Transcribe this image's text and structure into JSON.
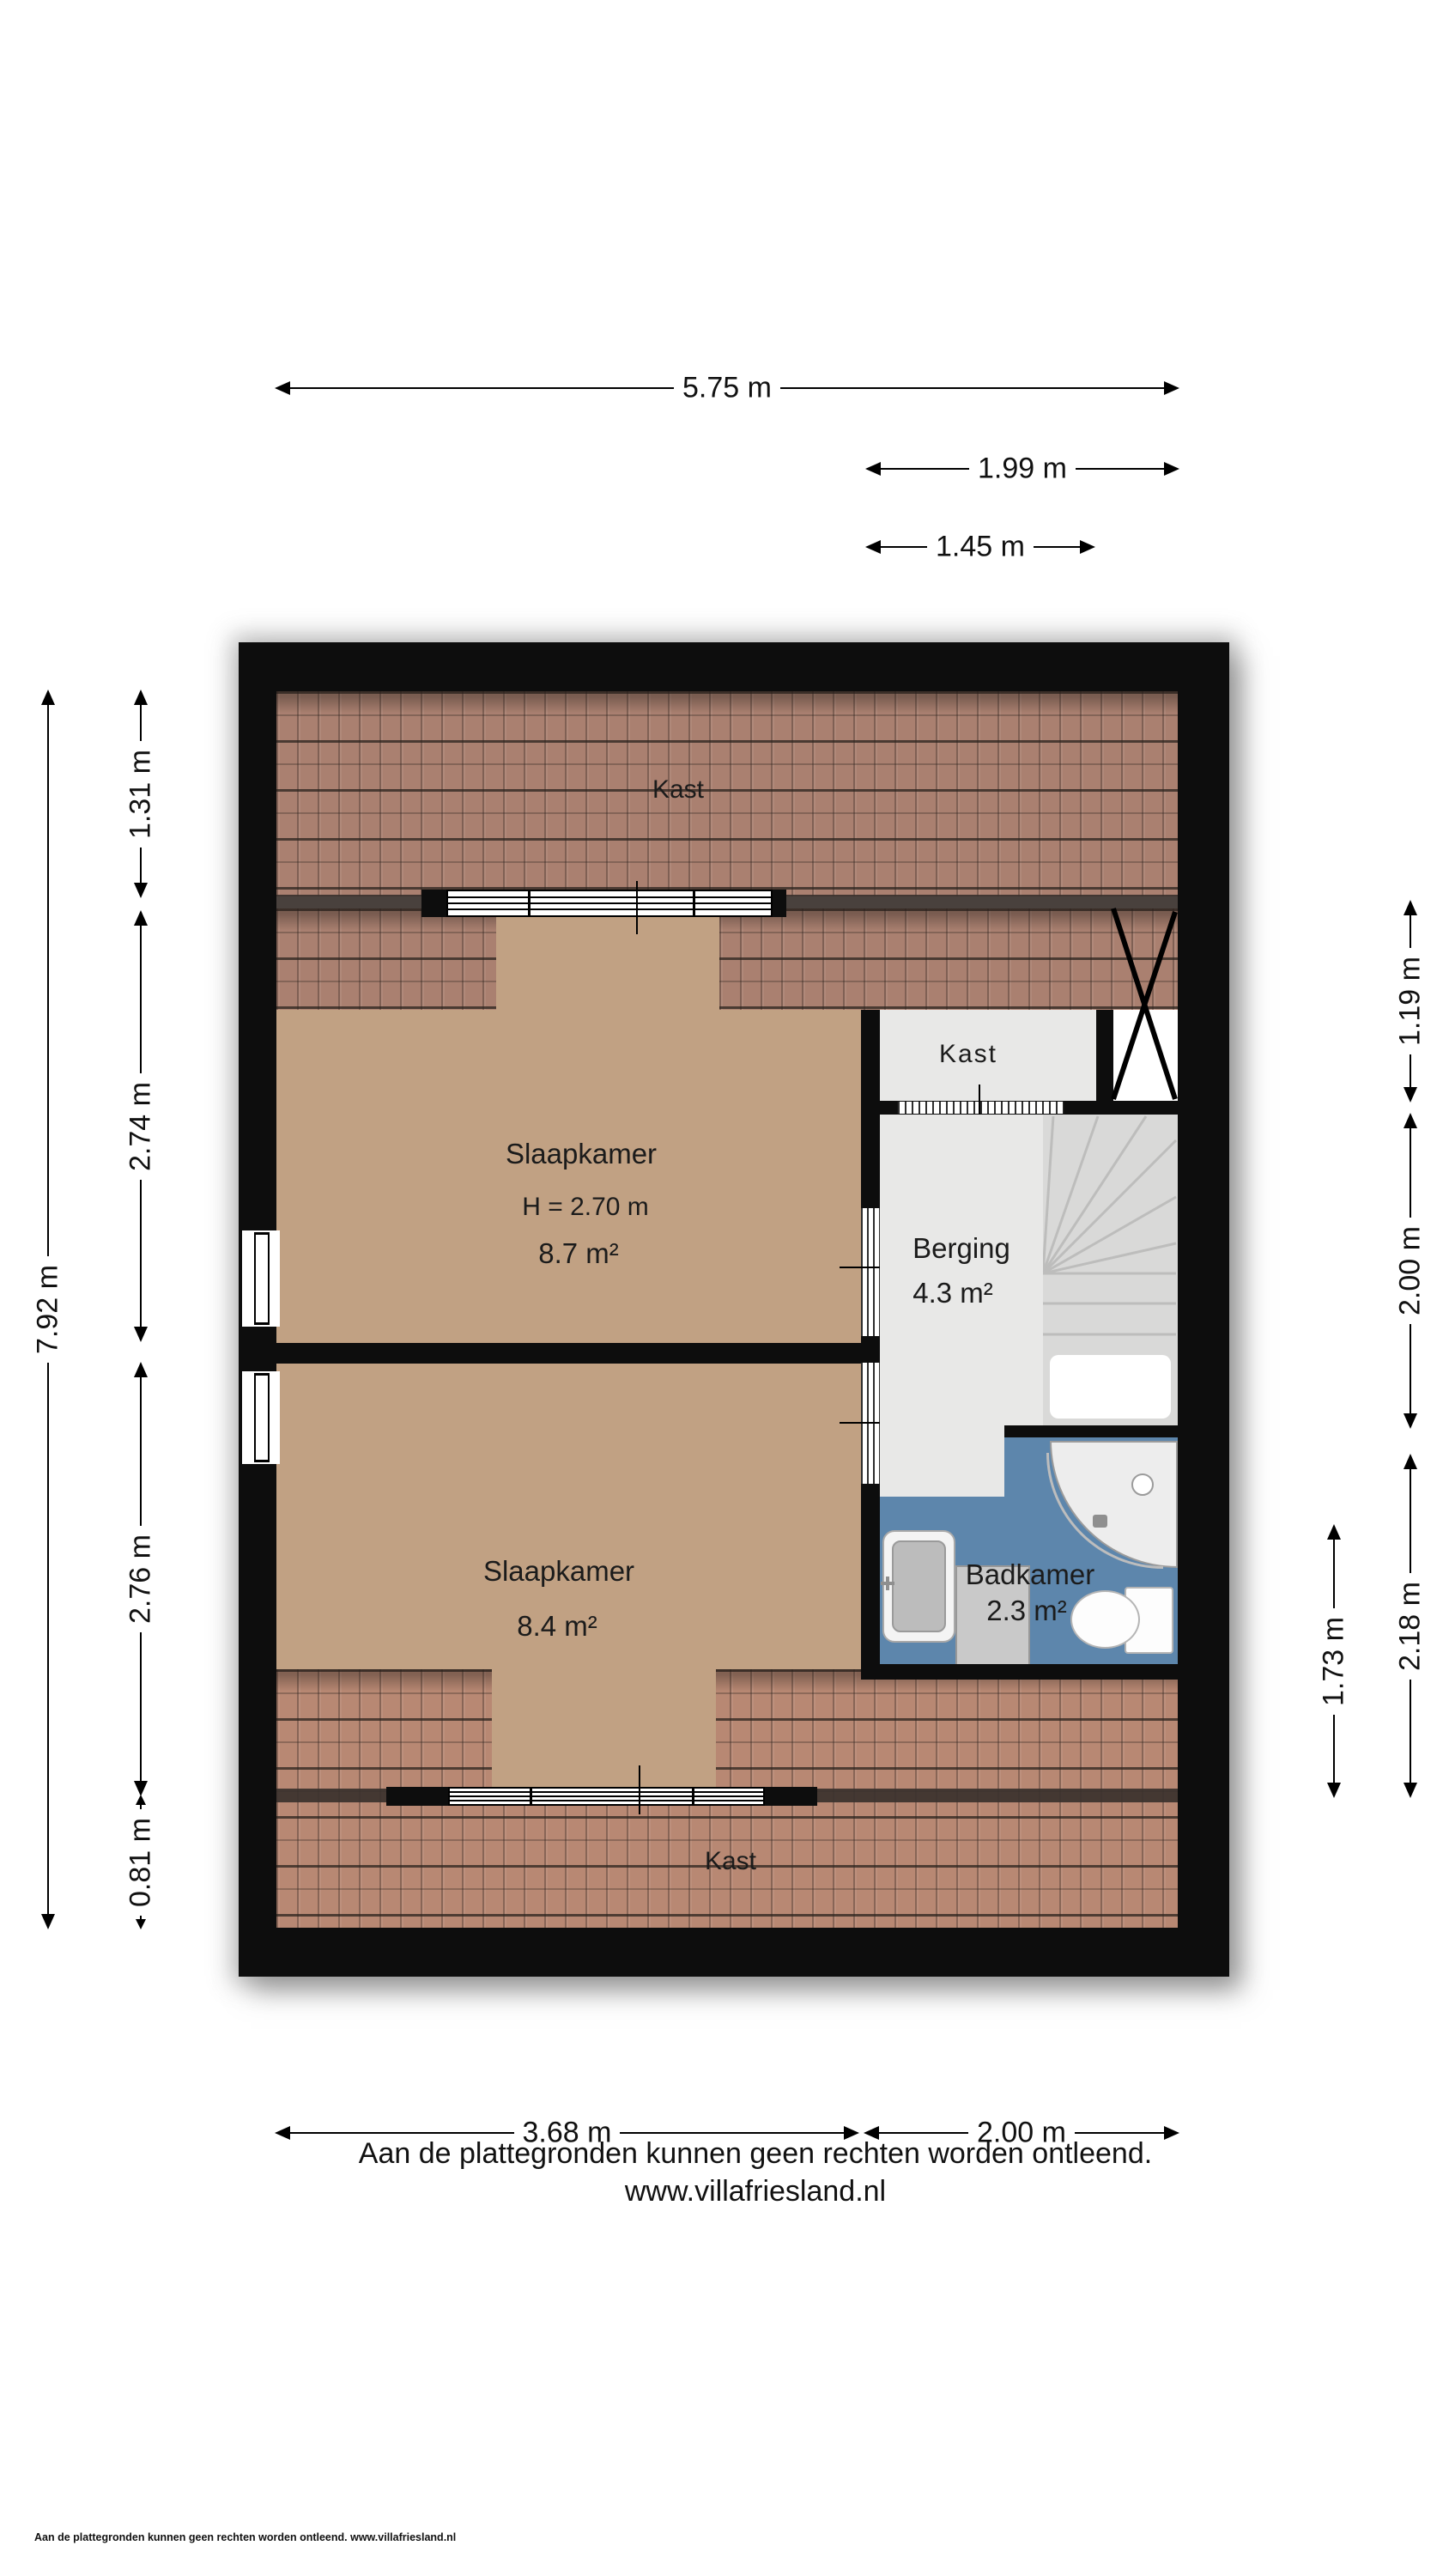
{
  "plan": {
    "rooms": {
      "kast_top": {
        "label": "Kast"
      },
      "slaapkamer_1": {
        "label": "Slaapkamer",
        "height_note": "H = 2.70 m",
        "area": "8.7 m²"
      },
      "kast_mid": {
        "label": "Kast"
      },
      "berging": {
        "label": "Berging",
        "area": "4.3 m²"
      },
      "slaapkamer_2": {
        "label": "Slaapkamer",
        "area": "8.4 m²"
      },
      "badkamer": {
        "label": "Badkamer",
        "area": "2.3 m²"
      },
      "kast_bottom": {
        "label": "Kast"
      }
    },
    "dimensions": {
      "top_total": "5.75 m",
      "top_hall": "1.99 m",
      "top_hall_inner": "1.45 m",
      "left_total": "7.92 m",
      "left_top": "1.31 m",
      "left_bed1": "2.74 m",
      "left_bed2": "2.76 m",
      "left_bottom": "0.81 m",
      "right_void": "1.19 m",
      "right_stairs": "2.00 m",
      "right_bath": "2.18 m",
      "right_bath_inner": "1.73 m",
      "bottom_bed": "3.68 m",
      "bottom_hall": "2.00 m"
    },
    "colors": {
      "wall": "#0d0d0d",
      "roof_tiles": "#aa8070",
      "roof_tiles_light": "#b88873",
      "floor_tan": "#c1a183",
      "floor_gray": "#e8e8e7",
      "bathroom_blue": "#5d86ac",
      "stairs_gray": "#d9d9d8"
    }
  },
  "footer": {
    "disclaimer": "Aan de plattegronden kunnen geen rechten worden ontleend.",
    "website": "www.villafriesland.nl",
    "small_print": "Aan de plattegronden kunnen geen rechten worden ontleend. www.villafriesland.nl"
  }
}
